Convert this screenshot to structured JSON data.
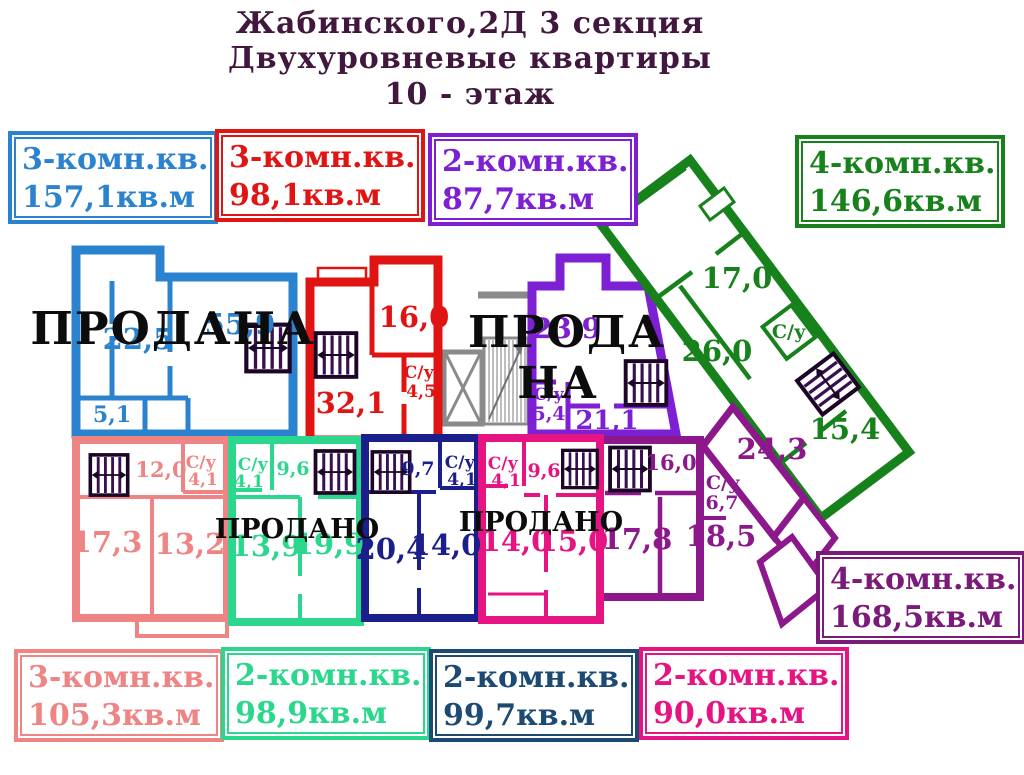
{
  "title": {
    "line1": "Жабинского,2Д  3 секция",
    "line2": "Двухуровневые квартиры",
    "line3": "10 - этаж"
  },
  "legend": {
    "blue": {
      "type": "3-комн.кв.",
      "area": "157,1кв.м"
    },
    "red": {
      "type": "3-комн.кв.",
      "area": "98,1кв.м"
    },
    "violet": {
      "type": "2-комн.кв.",
      "area": "87,7кв.м"
    },
    "green": {
      "type": "4-комн.кв.",
      "area": "146,6кв.м"
    },
    "purple": {
      "type": "4-комн.кв.",
      "area": "168,5кв.м"
    },
    "salmon": {
      "type": "3-комн.кв.",
      "area": "105,3кв.м"
    },
    "spring": {
      "type": "2-комн.кв.",
      "area": "98,9кв.м"
    },
    "navy": {
      "type": "2-комн.кв.",
      "area": "99,7кв.м"
    },
    "magenta": {
      "type": "2-комн.кв.",
      "area": "90,0кв.м"
    }
  },
  "plan": {
    "blue": {
      "r1": "22,5",
      "r2": "55,9",
      "r3": "5,1",
      "sold": "ПРОДАНА"
    },
    "red": {
      "r1": "16,0",
      "r2": "32,1",
      "su": "С/у",
      "su_area": "4,5"
    },
    "violet": {
      "r1": "23,9",
      "r2": "21,1",
      "su": "С/у",
      "su_area": "5,4",
      "sold1": "ПРОДА",
      "sold2": "НА"
    },
    "green": {
      "r1": "17,0",
      "r2": "26,0",
      "r3": "15,4",
      "su": "С/у"
    },
    "purple": {
      "r1": "16,0",
      "r2": "24,3",
      "r3": "17,8",
      "r4": "18,5",
      "su": "С/у",
      "su_area": "6,7"
    },
    "salmon": {
      "r1": "12,0",
      "r2": "17,3",
      "r3": "13,2",
      "su": "С/у",
      "su_area": "4,1"
    },
    "spring": {
      "r1": "9,6",
      "r2": "13,9",
      "r3": "19,9",
      "su": "С/у",
      "su_area": "4,1",
      "sold": "ПРОДАНО"
    },
    "navy": {
      "r1": "9,7",
      "r2": "20,4",
      "r3": "14,0",
      "su": "С/у",
      "su_area": "4,1"
    },
    "magenta": {
      "r1": "9,6",
      "r2": "14,0",
      "r3": "15,0",
      "su": "С/у",
      "su_area": "4,1",
      "sold": "ПРОДАНО"
    }
  },
  "icons": {
    "stairs": "stairs-flight-icon",
    "elevator": "elevator-shaft-icon",
    "staircase_core": "staircase-hatch-icon"
  },
  "colors": {
    "title": "#42173d",
    "blue": "#2b83cf",
    "red": "#e11414",
    "violet": "#7d1fd3",
    "green": "#17821c",
    "purple": "#8c188c",
    "salmon": "#ef8484",
    "spring": "#2bd78c",
    "navy_box": "#1d4a73",
    "navy_walls": "#1a1f8c",
    "magenta": "#e61483",
    "sold": "#0c0c0c",
    "core_gray": "#8a8a8a"
  }
}
